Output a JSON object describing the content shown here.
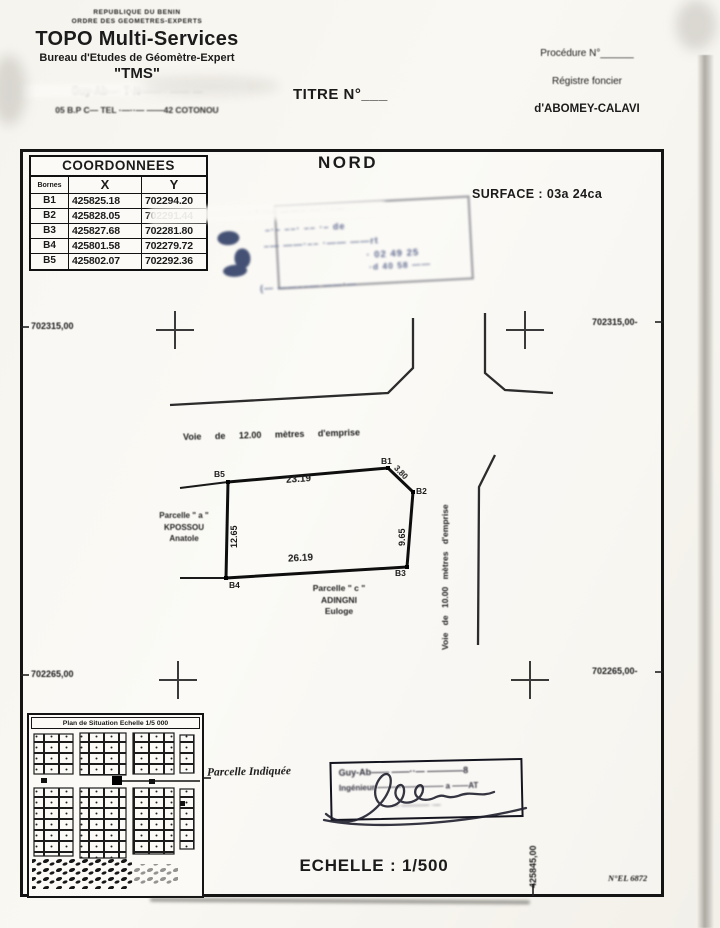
{
  "header": {
    "org_line1": "REPUBLIQUE DU BENIN",
    "org_line2": "ORDRE DES GEOMETRES-EXPERTS",
    "company": "TOPO Multi-Services",
    "bureau": "Bureau d'Etudes de Géomètre-Expert",
    "acronym": "\"TMS\"",
    "redacted_name": "Guy-Ab—·  T·N——··   ——   —",
    "address": "05 B.P  C—  TEL  ·—··—  ——42  COTONOU",
    "titre": "TITRE N°___",
    "procedure": "Procédure N°______",
    "registre": "Régistre foncier",
    "commune": "d'ABOMEY-CALAVI"
  },
  "table": {
    "title": "COORDONNEES",
    "col_bornes": "Bornes",
    "col_x": "X",
    "col_y": "Y",
    "rows": [
      [
        "B1",
        "425825.18",
        "702294.20"
      ],
      [
        "B2",
        "425828.05",
        "702291.44"
      ],
      [
        "B3",
        "425827.68",
        "702281.80"
      ],
      [
        "B4",
        "425801.58",
        "702279.72"
      ],
      [
        "B5",
        "425802.07",
        "702292.36"
      ]
    ]
  },
  "plan": {
    "north": "NORD",
    "surface": "SURFACE :  03a 24ca",
    "grid": {
      "top_left": "702315,00",
      "top_right": "702315,00-",
      "bottom_left": "702265,00",
      "bottom_right": "702265,00-",
      "bottom_vertical": "425845,00"
    },
    "road_h": "Voie de 12.00 mètres d'emprise",
    "road_v": "Voie de 10.00 mètres d'emprise",
    "bornes": {
      "b1": "B1",
      "b2": "B2",
      "b3": "B3",
      "b4": "B4",
      "b5": "B5"
    },
    "lengths": {
      "top": "23.19",
      "cut": "3.80",
      "right": "9.65",
      "bottom": "26.19",
      "left": "12.65"
    },
    "parcel_a": {
      "l1": "Parcelle \" a \"",
      "l2": "KPOSSOU",
      "l3": "Anatole"
    },
    "parcel_c": {
      "l1": "Parcelle \" c \"",
      "l2": "ADINGNI",
      "l3": "Euloge"
    }
  },
  "stamp": {
    "l1": "· ¹ ··–  ——–  ––  ·–—",
    "l2": "–·–  ––·  ––  ·–   de",
    "l3": "–—  ——·––  ·——  ——rt",
    "l4": "·  02 49 25",
    "l5": "·d 40 58 ——",
    "l6": "(— ——––—  ——·—"
  },
  "situation": {
    "title": "Plan de Situation   Echelle   1/5 000",
    "indicated": "Parcelle Indiquée"
  },
  "signature": {
    "l1": "Guy-Ab——  ——··—  ————8",
    "l2": "Ingénieur  ———  ————— a ——AT",
    "l3": "— ———— ·—"
  },
  "footer": {
    "scale": "ECHELLE : 1/500",
    "doc_no": "N°EL 6872"
  }
}
